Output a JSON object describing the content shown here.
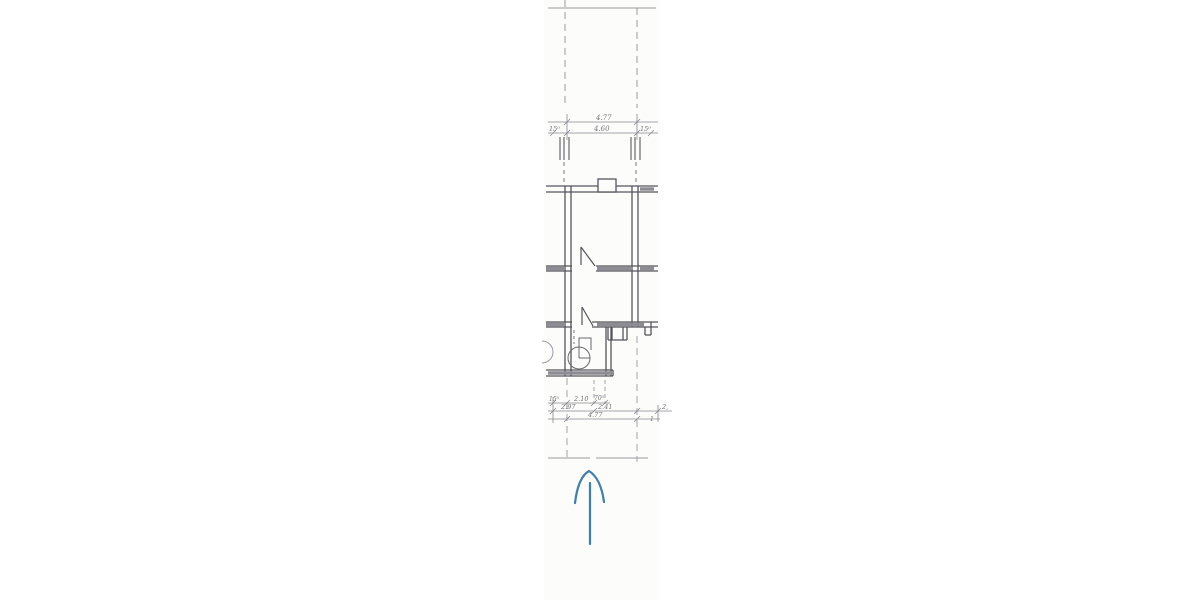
{
  "page": {
    "description": "Scanned fragment of a hand-drafted architectural floor plan (narrow vertical strip) with a hand-drawn blue arrow pointing up below the plan",
    "background_color": "#ffffff",
    "paper_color": "#fcfcfb"
  },
  "drawing": {
    "line_color": "#5b5b62",
    "light_line_color": "#9a9aa0",
    "wall_fill_color": "#8c8c92",
    "arrow_color": "#3d7fae",
    "top_dimensions": {
      "wall_left": "15⁰",
      "total_upper": "4.77",
      "total_lower": "4.60",
      "wall_right": "15⁰"
    },
    "bottom_dimensions": {
      "row1": [
        "15⁰",
        "2.10",
        "70⁵"
      ],
      "row2": [
        "2.97",
        "2.41",
        "2,"
      ],
      "row3": [
        "4.77"
      ],
      "right_mark": "1"
    }
  }
}
